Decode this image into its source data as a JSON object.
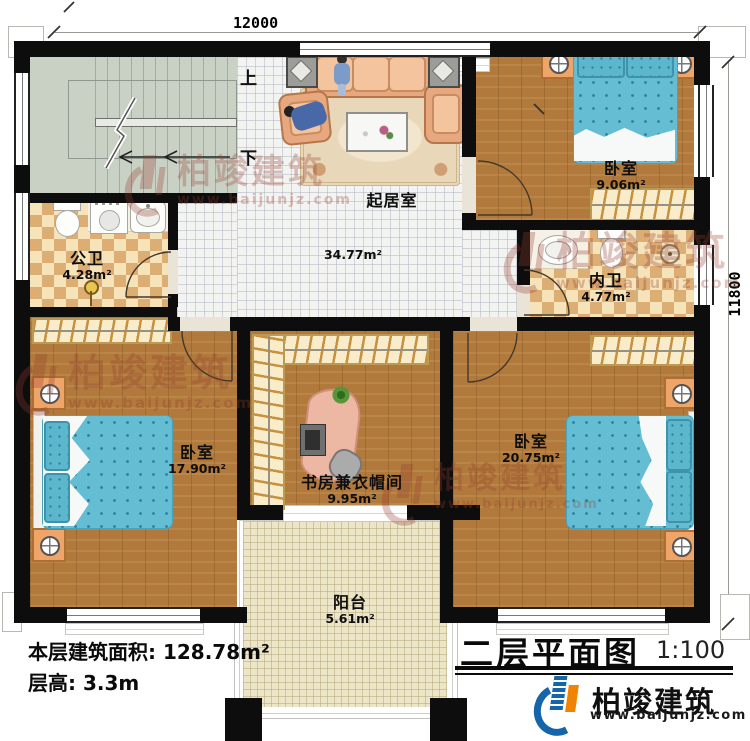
{
  "plan": {
    "title": "二层平面图",
    "scale": "1:100",
    "footer": {
      "floor_area": "本层建筑面积: 128.78m²",
      "floor_height": "层高: 3.3m"
    }
  },
  "dimensions": {
    "top": "12000",
    "right": "11800"
  },
  "stairs": {
    "up": "上",
    "down": "下"
  },
  "rooms": [
    {
      "name": "起居室",
      "area": "34.77m²"
    },
    {
      "name": "卧室",
      "area": "9.06m²"
    },
    {
      "name": "公卫",
      "area": "4.28m²"
    },
    {
      "name": "内卫",
      "area": "4.77m²"
    },
    {
      "name": "卧室",
      "area": "17.90m²"
    },
    {
      "name": "书房兼衣帽间",
      "area": "9.95m²"
    },
    {
      "name": "卧室",
      "area": "20.75m²"
    },
    {
      "name": "阳台",
      "area": "5.61m²"
    }
  ],
  "brand": {
    "name": "柏竣建筑",
    "url": "www.baijunjz.com"
  },
  "watermark": {
    "name": "柏竣建筑",
    "url": "www.baijunjz.com"
  },
  "legend_symbols": [
    "stairs",
    "door-swing",
    "window",
    "bed",
    "nightstand-lamp",
    "wardrobe-hangers",
    "sofa",
    "coffee-table",
    "rug",
    "side-table",
    "toilet",
    "sink",
    "washing-machine",
    "shower",
    "desk",
    "office-chair",
    "monitor",
    "plant",
    "balcony-railing"
  ],
  "colors": {
    "wall": "#0d0d0d",
    "wood_floor": "#b17a3c",
    "tile_floor": "#f3f4f1",
    "bath_tile_light": "#f6e3ba",
    "bath_tile_dark": "#dcae74",
    "stairs_floor": "#c9d1c5",
    "balcony_floor": "#ece5c8",
    "bed_blue": "#65bdd3",
    "nightstand_orange": "#efa468",
    "brand_blue": "#1565ab",
    "brand_orange": "#f08300",
    "watermark": "#943a2e"
  }
}
